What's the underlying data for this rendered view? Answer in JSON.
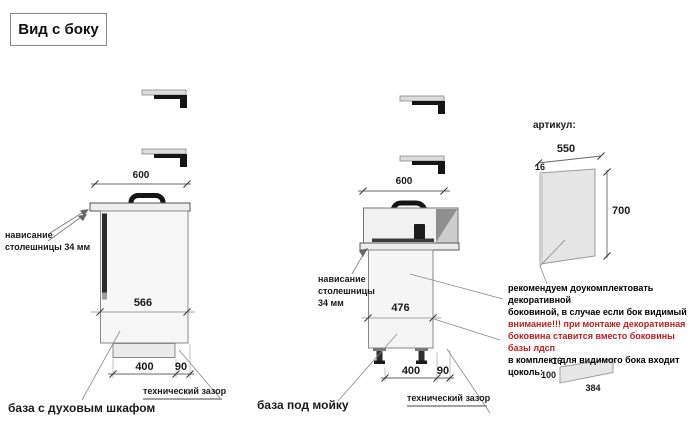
{
  "title": "Вид с боку",
  "cabinet_oven": {
    "caption": "база с духовым шкафом",
    "top_width": "600",
    "depth": "566",
    "plinth_depth": "400",
    "rear_gap": "90",
    "overhang_line1": "нависание",
    "overhang_line2": "столешницы 34 мм",
    "gap_label": "технический зазор"
  },
  "cabinet_sink": {
    "caption": "база под мойку",
    "top_width": "600",
    "depth": "476",
    "plinth_depth": "400",
    "rear_gap": "90",
    "overhang_line1": "нависание",
    "overhang_line2": "столешницы",
    "overhang_line3": "34 мм",
    "gap_label": "технический зазор"
  },
  "side_panel": {
    "label": "артикул:",
    "width": "550",
    "thickness": "16",
    "height": "700"
  },
  "note": {
    "line1": "рекомендуем доукомплектовать декоративной",
    "line2": "боковиной, в случае если бок видимый",
    "line3": "внимание!!! при монтаже декоративная",
    "line4": "боковина ставится вместо боковины базы лдсп",
    "line5": "в комплект для видимого бока входит цоколь:",
    "warning_color": "#b22222"
  },
  "plinth": {
    "thickness": "16",
    "height": "100",
    "width": "384"
  }
}
